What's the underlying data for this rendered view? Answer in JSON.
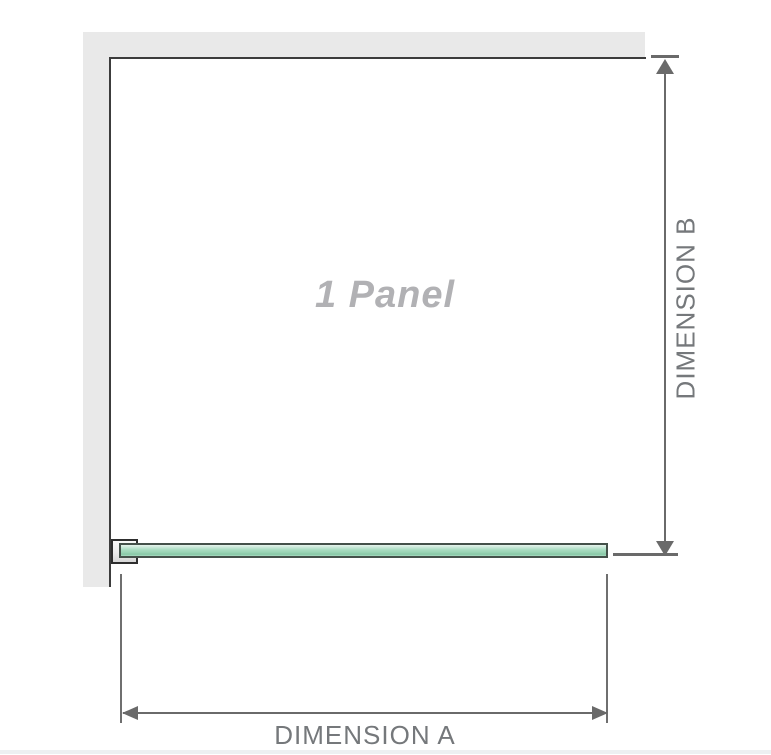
{
  "diagram": {
    "panel_label": "1 Panel",
    "dimension_a_label": "DIMENSION A",
    "dimension_b_label": "DIMENSION B"
  },
  "colors": {
    "wall_fill": "#e9e9e9",
    "panel_outline": "#3c3c3c",
    "dimension_line": "#6a6a6a",
    "dimension_text": "#75787b",
    "panel_label_text": "#b1b1b4",
    "glass_border": "#44514a",
    "glass_highlight": "#e6f4ec",
    "glass_fill": "#aaddc3",
    "glass_shadow": "#88c8a6",
    "bracket_fill": "#ececec",
    "bracket_outline": "#2e2e2e",
    "bottom_edge": "#edf0f2"
  }
}
